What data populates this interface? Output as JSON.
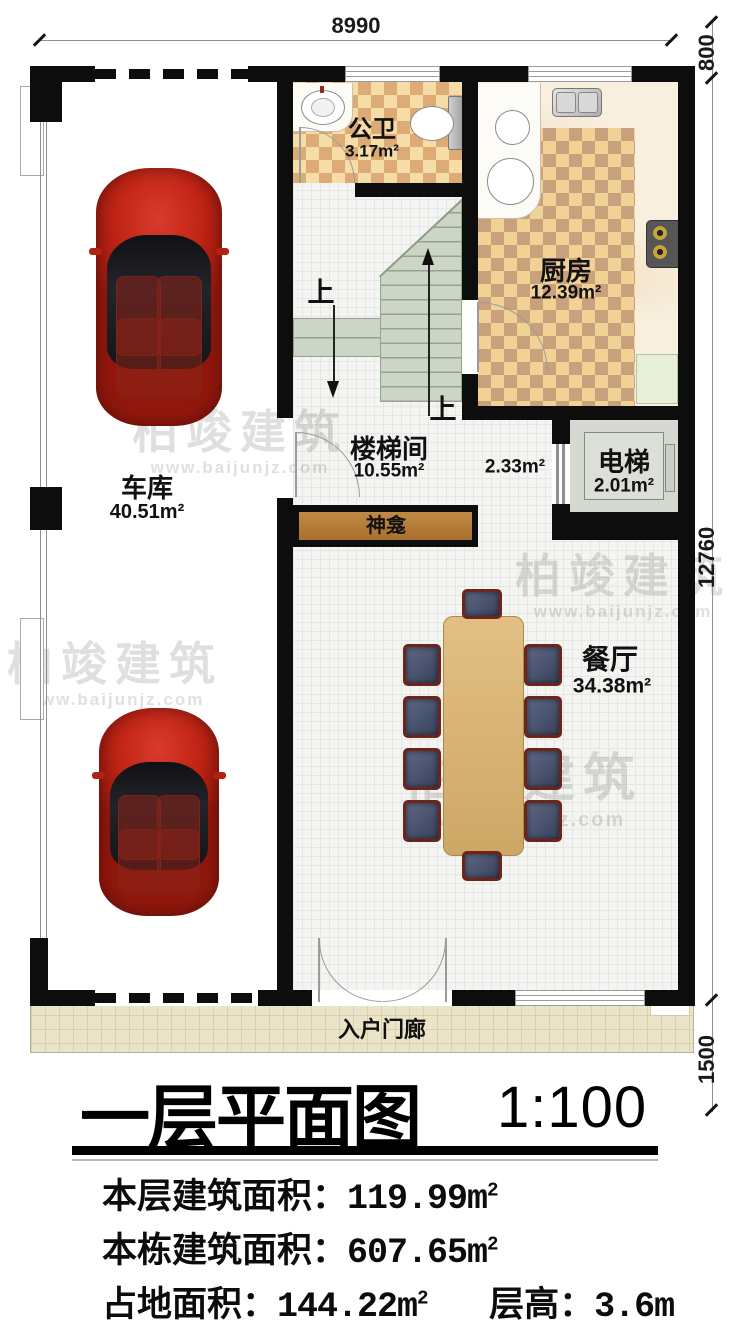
{
  "plan": {
    "dims": {
      "top": "8990",
      "right_top": "800",
      "right_middle": "12760",
      "right_bottom": "1500"
    },
    "rooms": {
      "bathroom": {
        "name": "公卫",
        "area": "3.17m²"
      },
      "kitchen": {
        "name": "厨房",
        "area": "12.39m²"
      },
      "stairwell": {
        "name": "楼梯间",
        "area": "10.55m²"
      },
      "elevator": {
        "name": "电梯",
        "area": "2.01m²"
      },
      "garage": {
        "name": "车库",
        "area": "40.51m²"
      },
      "dining": {
        "name": "餐厅",
        "area": "34.38m²"
      },
      "shrine": {
        "name": "神龛"
      },
      "porch": {
        "name": "入户门廊"
      },
      "hall_area": "2.33m²"
    },
    "stair_up_1": "上",
    "stair_up_2": "上"
  },
  "watermark": {
    "brand": "柏竣建筑",
    "url": "www.baijunjz.com"
  },
  "footer": {
    "title": "一层平面图",
    "scale": "1:100",
    "row1": {
      "label": "本层建筑面积：",
      "value": "119.99m",
      "sup": "2"
    },
    "row2": {
      "label": "本栋建筑面积：",
      "value": "607.65m",
      "sup": "2"
    },
    "row3": {
      "label": "占地面积：",
      "value": "144.22m",
      "sup": "2",
      "label2": "层高：",
      "value2": "3.6m"
    }
  },
  "colors": {
    "wall": "#0d0d0d",
    "checker_light": "#f6dca6",
    "checker_dark": "#dcab76",
    "stair": "#ccd6c6",
    "shrine": "#b8803d",
    "porch": "#ebe4c8",
    "car": "#c02415"
  }
}
